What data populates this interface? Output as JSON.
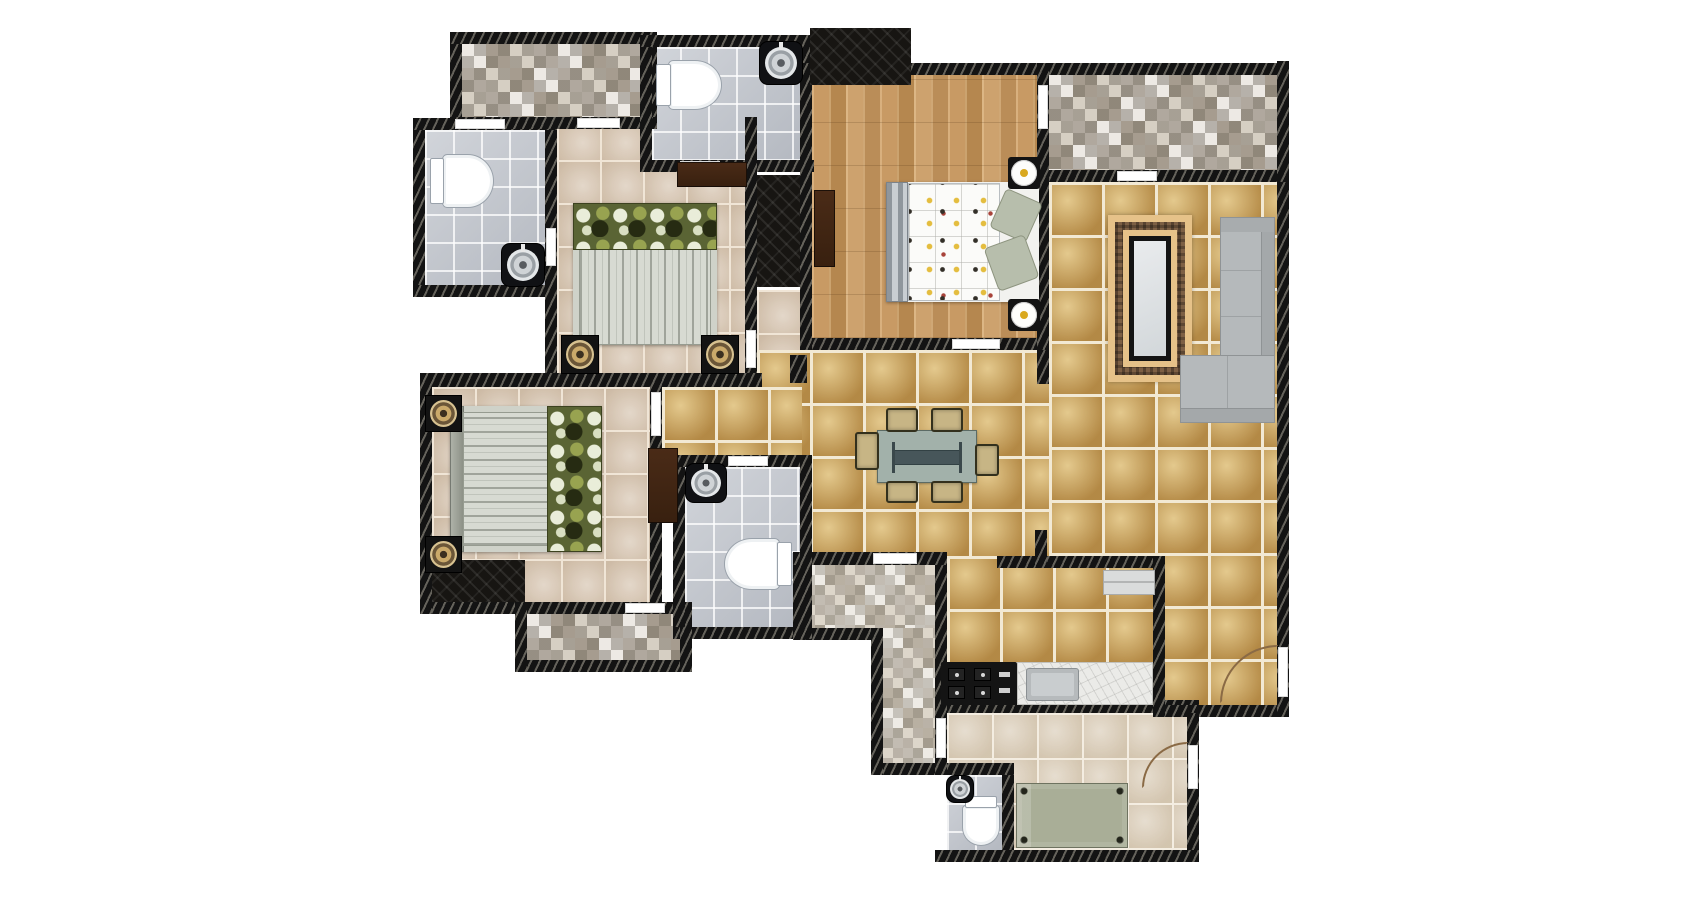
{
  "meta": {
    "kind": "apartment-floor-plan",
    "canvas_w": 1700,
    "canvas_h": 898
  },
  "palette": {
    "background": "#ffffff",
    "wall": "#131313",
    "wall_hatch": "#c8c3b2",
    "bedroom_tile": "#d9c8b5",
    "bath_tile": "#c6cad1",
    "wood_floor": "#c1945f",
    "gold_tile": "#c39a52",
    "kitchen_tile": "#dccfbb",
    "mosaic_dark": "#8c8478",
    "mosaic_light": "#ddd6ca",
    "cabinet_brown": "#4a2b17",
    "sofa_gray": "#b5b9bb",
    "table_green": "#a2b1aa",
    "chair_khaki": "#c7b585",
    "utility_bed_green": "#a9ae97",
    "frame_tan": "#e6c289",
    "frame_brown": "#7c5f44",
    "lamp_yellow": "#d9a81e",
    "pillow_olive": "#5a6434"
  },
  "floors": [
    {
      "name": "bedroom2-floor",
      "type": "bedroom",
      "r": [
        557,
        117,
        188,
        256
      ]
    },
    {
      "name": "corridor-floor",
      "type": "bedroom",
      "r": [
        757,
        290,
        43,
        62
      ]
    },
    {
      "name": "bedroom3-floor",
      "type": "bedroom",
      "r": [
        432,
        387,
        218,
        215
      ]
    },
    {
      "name": "living-floor-right",
      "type": "gold",
      "r": [
        1049,
        182,
        228,
        523
      ]
    },
    {
      "name": "living-floor-center",
      "type": "gold",
      "r": [
        757,
        350,
        292,
        206
      ]
    },
    {
      "name": "hall-floor-west",
      "type": "gold",
      "r": [
        662,
        387,
        140,
        75
      ]
    },
    {
      "name": "kitchen-floor",
      "type": "gold",
      "r": [
        947,
        556,
        218,
        157
      ]
    },
    {
      "name": "master-bedroom-floor",
      "type": "wood",
      "r": [
        812,
        75,
        225,
        263
      ]
    },
    {
      "name": "dressing-floor",
      "type": "mosaic",
      "r": [
        462,
        44,
        183,
        73
      ]
    },
    {
      "name": "balcony1-floor",
      "type": "mosaic",
      "r": [
        1049,
        73,
        228,
        97
      ]
    },
    {
      "name": "balcony2-floor",
      "type": "mosaic",
      "r": [
        527,
        614,
        153,
        46
      ]
    },
    {
      "name": "passage-floor-h",
      "type": "mosaic2",
      "r": [
        805,
        565,
        130,
        63
      ]
    },
    {
      "name": "passage-floor-v",
      "type": "mosaic2",
      "r": [
        883,
        628,
        52,
        135
      ]
    },
    {
      "name": "bath1-floor",
      "type": "bath",
      "r": [
        425,
        130,
        120,
        155
      ]
    },
    {
      "name": "bath2-floor",
      "type": "bath",
      "r": [
        652,
        47,
        148,
        113
      ]
    },
    {
      "name": "bath3-floor",
      "type": "bath",
      "r": [
        685,
        467,
        115,
        160
      ]
    },
    {
      "name": "utility-floor",
      "type": "kitchenfloor",
      "r": [
        947,
        713,
        240,
        137
      ]
    },
    {
      "name": "utility-bath-floor",
      "type": "bath",
      "r": [
        947,
        775,
        55,
        75
      ]
    }
  ],
  "walls": [
    {
      "name": "wall-dressing-top",
      "r": [
        450,
        32,
        207,
        12
      ]
    },
    {
      "name": "wall-bath1-top",
      "r": [
        413,
        118,
        144,
        12
      ]
    },
    {
      "name": "wall-dressing-bottom",
      "r": [
        450,
        117,
        207,
        12
      ]
    },
    {
      "name": "wall-bath2-top",
      "r": [
        640,
        35,
        174,
        12
      ]
    },
    {
      "name": "wall-bath2-bottom",
      "r": [
        640,
        160,
        174,
        12
      ]
    },
    {
      "name": "wall-bath1-bottom",
      "r": [
        413,
        285,
        144,
        12
      ]
    },
    {
      "name": "wall-bedrooms-divider",
      "r": [
        420,
        373,
        342,
        14
      ]
    },
    {
      "name": "wall-top-main",
      "r": [
        800,
        63,
        489,
        12
      ]
    },
    {
      "name": "wall-balcony1-bottom",
      "r": [
        1037,
        170,
        252,
        12
      ]
    },
    {
      "name": "wall-master-bottom",
      "r": [
        800,
        338,
        249,
        12
      ]
    },
    {
      "name": "wall-bedroom3-bottom",
      "r": [
        420,
        602,
        272,
        12
      ]
    },
    {
      "name": "wall-balcony2-bottom",
      "r": [
        515,
        660,
        177,
        12
      ]
    },
    {
      "name": "wall-bath3-top",
      "r": [
        673,
        455,
        139,
        12
      ]
    },
    {
      "name": "wall-bath3-bottom",
      "r": [
        673,
        627,
        139,
        12
      ]
    },
    {
      "name": "wall-passage-top",
      "r": [
        793,
        552,
        154,
        13
      ]
    },
    {
      "name": "wall-kitchen-top",
      "r": [
        997,
        556,
        168,
        12
      ]
    },
    {
      "name": "wall-passage-notch",
      "r": [
        793,
        628,
        90,
        12
      ]
    },
    {
      "name": "wall-kitchen-utility-divider",
      "r": [
        947,
        700,
        252,
        13
      ]
    },
    {
      "name": "wall-utility-bottom",
      "r": [
        935,
        850,
        264,
        12
      ]
    },
    {
      "name": "wall-passage-bottom",
      "r": [
        871,
        763,
        143,
        12
      ]
    },
    {
      "name": "wall-bottom-right",
      "r": [
        1153,
        705,
        136,
        12
      ]
    },
    {
      "name": "wall-dressing-left",
      "r": [
        450,
        44,
        12,
        73
      ]
    },
    {
      "name": "wall-dressing-right",
      "r": [
        645,
        44,
        12,
        73
      ]
    },
    {
      "name": "wall-bath1-left",
      "r": [
        413,
        130,
        12,
        155
      ]
    },
    {
      "name": "wall-bath1-right",
      "r": [
        545,
        130,
        12,
        243
      ]
    },
    {
      "name": "wall-bath2-left",
      "r": [
        640,
        47,
        12,
        113
      ]
    },
    {
      "name": "wall-bath2-right",
      "r": [
        800,
        35,
        12,
        137
      ]
    },
    {
      "name": "wall-bedroom2-right",
      "r": [
        745,
        117,
        12,
        256
      ]
    },
    {
      "name": "wall-master-left",
      "r": [
        800,
        63,
        12,
        287
      ]
    },
    {
      "name": "wall-master-right",
      "r": [
        1037,
        63,
        12,
        287
      ]
    },
    {
      "name": "wall-balcony1-right",
      "r": [
        1277,
        61,
        12,
        121
      ]
    },
    {
      "name": "wall-right-main",
      "r": [
        1277,
        182,
        12,
        535
      ]
    },
    {
      "name": "wall-bedroom3-left",
      "r": [
        420,
        373,
        12,
        241
      ]
    },
    {
      "name": "wall-bedroom3-right",
      "r": [
        650,
        373,
        12,
        241
      ]
    },
    {
      "name": "wall-balcony2-left",
      "r": [
        515,
        602,
        12,
        70
      ]
    },
    {
      "name": "wall-balcony2-right",
      "r": [
        680,
        602,
        12,
        70
      ]
    },
    {
      "name": "wall-bath3-left",
      "r": [
        673,
        467,
        12,
        160
      ]
    },
    {
      "name": "wall-bath3-right",
      "r": [
        800,
        455,
        12,
        184
      ]
    },
    {
      "name": "wall-passage-left-upper",
      "r": [
        793,
        565,
        12,
        75
      ]
    },
    {
      "name": "wall-passage-left-lower",
      "r": [
        871,
        628,
        12,
        147
      ]
    },
    {
      "name": "wall-passage-right",
      "r": [
        935,
        565,
        12,
        210
      ]
    },
    {
      "name": "wall-kitchen-right",
      "r": [
        1153,
        556,
        12,
        161
      ]
    },
    {
      "name": "wall-utility-bath-right",
      "r": [
        1002,
        775,
        12,
        75
      ]
    },
    {
      "name": "wall-utility-right",
      "r": [
        1187,
        713,
        12,
        137
      ]
    },
    {
      "name": "wall-stub-kitchen",
      "r": [
        1035,
        530,
        12,
        38
      ]
    },
    {
      "name": "wall-stub-hall",
      "r": [
        1037,
        350,
        12,
        34
      ]
    },
    {
      "name": "wall-stub-hall-left",
      "r": [
        790,
        355,
        17,
        28
      ]
    }
  ],
  "gaps": [
    {
      "name": "window-bath1",
      "r": [
        455,
        119,
        50,
        10
      ]
    },
    {
      "name": "door-dressing-bedroom2",
      "r": [
        577,
        118,
        43,
        10
      ]
    },
    {
      "name": "door-bath1",
      "r": [
        546,
        228,
        10,
        38
      ]
    },
    {
      "name": "door-bath2",
      "r": [
        680,
        161,
        40,
        10
      ]
    },
    {
      "name": "door-master-balcony",
      "r": [
        1038,
        85,
        10,
        44
      ]
    },
    {
      "name": "door-balcony1",
      "r": [
        1117,
        171,
        40,
        10
      ]
    },
    {
      "name": "door-master",
      "r": [
        952,
        339,
        48,
        10
      ]
    },
    {
      "name": "door-bedroom2",
      "r": [
        746,
        330,
        10,
        38
      ]
    },
    {
      "name": "door-bedroom3",
      "r": [
        651,
        392,
        10,
        44
      ]
    },
    {
      "name": "door-balcony2",
      "r": [
        625,
        603,
        40,
        10
      ]
    },
    {
      "name": "door-bath3",
      "r": [
        728,
        456,
        40,
        10
      ]
    },
    {
      "name": "door-passage",
      "r": [
        873,
        553,
        44,
        11
      ]
    },
    {
      "name": "door-utility-passage",
      "r": [
        936,
        718,
        10,
        40
      ]
    },
    {
      "name": "door-living-right",
      "r": [
        1278,
        647,
        10,
        50
      ]
    },
    {
      "name": "door-utility-right",
      "r": [
        1188,
        745,
        10,
        44
      ]
    }
  ],
  "closets": [
    {
      "name": "closet-entry",
      "r": [
        810,
        28,
        101,
        57
      ]
    },
    {
      "name": "closet-bedroom3",
      "r": [
        432,
        560,
        93,
        42
      ]
    },
    {
      "name": "closet-corridor",
      "r": [
        757,
        175,
        43,
        112
      ]
    }
  ],
  "cabinets": [
    {
      "name": "wardrobe-bedroom2",
      "r": [
        677,
        162,
        70,
        25
      ]
    },
    {
      "name": "wardrobe-bedroom3",
      "r": [
        648,
        448,
        30,
        75
      ]
    },
    {
      "name": "wardrobe-master",
      "r": [
        814,
        190,
        21,
        77
      ]
    }
  ],
  "items": [
    {
      "name": "toilet-bath1",
      "type": "toilet",
      "dir": "right",
      "r": [
        430,
        154,
        64,
        54
      ]
    },
    {
      "name": "toilet-bath2",
      "type": "toilet",
      "dir": "right",
      "r": [
        656,
        60,
        66,
        50
      ]
    },
    {
      "name": "toilet-bath3",
      "type": "toilet",
      "dir": "left",
      "r": [
        724,
        538,
        68,
        52
      ]
    },
    {
      "name": "toilet-utility-bath",
      "type": "toilet",
      "dir": "down",
      "r": [
        962,
        796,
        38,
        50
      ]
    },
    {
      "name": "sink-bath1",
      "type": "sink",
      "r": [
        502,
        244,
        42,
        42
      ]
    },
    {
      "name": "sink-bath2",
      "type": "sink",
      "r": [
        760,
        42,
        42,
        42
      ]
    },
    {
      "name": "sink-bath3",
      "type": "sink",
      "r": [
        686,
        464,
        40,
        38
      ]
    },
    {
      "name": "sink-utility-bath",
      "type": "sink",
      "r": [
        947,
        776,
        26,
        26
      ]
    },
    {
      "name": "bed-bedroom2",
      "type": "bed-duvet",
      "orient": "v",
      "r": [
        573,
        203,
        144,
        142
      ]
    },
    {
      "name": "bed-bedroom3",
      "type": "bed-duvet",
      "orient": "h",
      "r": [
        450,
        406,
        152,
        146
      ]
    },
    {
      "name": "bed-master",
      "type": "bed-master",
      "r": [
        886,
        182,
        153,
        120
      ]
    },
    {
      "name": "bed-utility",
      "type": "bed-plain",
      "r": [
        1016,
        783,
        112,
        65
      ]
    },
    {
      "name": "nightstand-bedroom2-left",
      "type": "lamp-square",
      "r": [
        562,
        336,
        36,
        37
      ]
    },
    {
      "name": "nightstand-bedroom2-right",
      "type": "lamp-square",
      "r": [
        702,
        336,
        36,
        37
      ]
    },
    {
      "name": "nightstand-bedroom3-top",
      "type": "lamp-square",
      "r": [
        426,
        396,
        35,
        35
      ]
    },
    {
      "name": "nightstand-bedroom3-bottom",
      "type": "lamp-square",
      "r": [
        426,
        537,
        35,
        35
      ]
    },
    {
      "name": "nightstand-master-top",
      "type": "lamp-round",
      "r": [
        1008,
        157,
        32,
        32
      ]
    },
    {
      "name": "nightstand-master-bottom",
      "type": "lamp-round",
      "r": [
        1008,
        299,
        32,
        32
      ]
    },
    {
      "name": "dining-table",
      "type": "table",
      "r": [
        877,
        430,
        100,
        53
      ]
    },
    {
      "name": "dining-chair-1",
      "type": "chair",
      "r": [
        886,
        408,
        32,
        24
      ]
    },
    {
      "name": "dining-chair-2",
      "type": "chair",
      "r": [
        931,
        408,
        32,
        24
      ]
    },
    {
      "name": "dining-chair-3",
      "type": "chair",
      "r": [
        886,
        481,
        32,
        22
      ]
    },
    {
      "name": "dining-chair-4",
      "type": "chair",
      "r": [
        931,
        481,
        32,
        22
      ]
    },
    {
      "name": "dining-chair-5",
      "type": "chair",
      "r": [
        855,
        432,
        24,
        38
      ]
    },
    {
      "name": "dining-chair-6",
      "type": "chair",
      "r": [
        975,
        444,
        24,
        32
      ]
    },
    {
      "name": "framed-rug",
      "type": "frame",
      "r": [
        1108,
        215,
        84,
        167
      ]
    },
    {
      "name": "sofa-vertical",
      "type": "sofa",
      "variant": "right",
      "r": [
        1220,
        217,
        55,
        146
      ]
    },
    {
      "name": "sofa-chaise",
      "type": "sofa",
      "variant": "bottom",
      "r": [
        1180,
        355,
        95,
        68
      ]
    },
    {
      "name": "stove-counter",
      "type": "stove",
      "r": [
        941,
        662,
        76,
        43
      ]
    },
    {
      "name": "kitchen-counter",
      "type": "counter",
      "r": [
        1017,
        662,
        136,
        43
      ]
    },
    {
      "name": "kitchen-shelf",
      "type": "shelf",
      "r": [
        1103,
        570,
        52,
        25
      ]
    }
  ],
  "arcs": [
    {
      "name": "door-arc-living",
      "r": [
        1220,
        645,
        58,
        58
      ]
    },
    {
      "name": "door-arc-utility",
      "r": [
        1142,
        742,
        46,
        46
      ]
    }
  ]
}
